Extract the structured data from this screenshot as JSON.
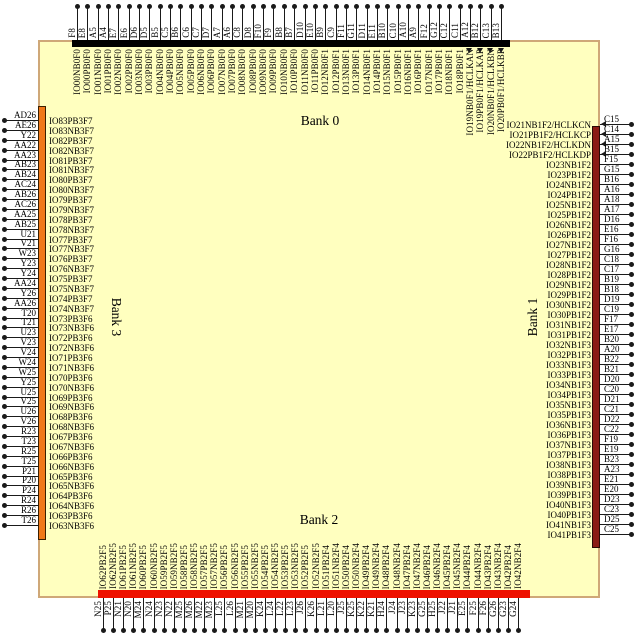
{
  "colors": {
    "die_fill": "#ffffbf",
    "die_border": "#cfa878",
    "bank0_bar": "#000000",
    "bank1_bar": "#8b1c15",
    "bank2_bar": "#ee1100",
    "bank3_bar": "#f07818",
    "wire": "#1a1a1a"
  },
  "banks": {
    "top": {
      "label": "Bank 0",
      "pins": [
        [
          "F8",
          "IO00NB0F0"
        ],
        [
          "E8",
          "IO00PB0F0"
        ],
        [
          "A5",
          "IO01NB0F0"
        ],
        [
          "A4",
          "IO01PB0F0"
        ],
        [
          "E7",
          "IO02NB0F0"
        ],
        [
          "E6",
          "IO02PB0F0"
        ],
        [
          "D6",
          "IO03NB0F0"
        ],
        [
          "D5",
          "IO03PB0F0"
        ],
        [
          "B5",
          "IO04NB0F0"
        ],
        [
          "C5",
          "IO04PB0F0"
        ],
        [
          "B6",
          "IO05NB0F0"
        ],
        [
          "C6",
          "IO05PB0F0"
        ],
        [
          "C7",
          "IO06NB0F0"
        ],
        [
          "D7",
          "IO06PB0F0"
        ],
        [
          "A7",
          "IO07NB0F0"
        ],
        [
          "A6",
          "IO07PB0F0"
        ],
        [
          "C8",
          "IO08NB0F0"
        ],
        [
          "D8",
          "IO08PB0F0"
        ],
        [
          "F10",
          "IO09NB0F0"
        ],
        [
          "F9",
          "IO09PB0F0"
        ],
        [
          "B8",
          "IO10NB0F0"
        ],
        [
          "B7",
          "IO10PB0F0"
        ],
        [
          "D10",
          "IO11NB0F0"
        ],
        [
          "E10",
          "IO11PB0F0"
        ],
        [
          "B9",
          "IO12NB0F1"
        ],
        [
          "C9",
          "IO12PB0F1"
        ],
        [
          "F11",
          "IO13NB0F1"
        ],
        [
          "G11",
          "IO13PB0F1"
        ],
        [
          "D11",
          "IO14NB0F1"
        ],
        [
          "E11",
          "IO14PB0F1"
        ],
        [
          "B10",
          "IO15NB0F1"
        ],
        [
          "C10",
          "IO15PB0F1"
        ],
        [
          "A10",
          "IO16NB0F1"
        ],
        [
          "A9",
          "IO16PB0F1"
        ],
        [
          "F12",
          "IO17NB0F1"
        ],
        [
          "G12",
          "IO17PB0F1"
        ],
        [
          "C12",
          "IO18NB0F1"
        ],
        [
          "C11",
          "IO18PB0F1"
        ],
        [
          "A12",
          "IO19NB0F1/HCLKAN"
        ],
        [
          "B12",
          "IO19PB0F1/HCLKAP"
        ],
        [
          "C13",
          "IO20NB0F1/HCLKBN"
        ],
        [
          "B13",
          "IO20PB0F1/HCLKBP"
        ]
      ]
    },
    "right": {
      "label": "Bank 1",
      "pins": [
        [
          "C15",
          "IO21NB1F2/HCLKCN"
        ],
        [
          "C14",
          "IO21PB1F2/HCLKCP"
        ],
        [
          "A15",
          "IO22NB1F2/HCLKDN"
        ],
        [
          "B15",
          "IO22PB1F2/HCLKDP"
        ],
        [
          "F15",
          "IO23NB1F2"
        ],
        [
          "G15",
          "IO23PB1F2"
        ],
        [
          "B16",
          "IO24NB1F2"
        ],
        [
          "A16",
          "IO24PB1F2"
        ],
        [
          "A18",
          "IO25NB1F2"
        ],
        [
          "A17",
          "IO25PB1F2"
        ],
        [
          "D16",
          "IO26NB1F2"
        ],
        [
          "E16",
          "IO26PB1F2"
        ],
        [
          "F16",
          "IO27NB1F2"
        ],
        [
          "G16",
          "IO27PB1F2"
        ],
        [
          "C18",
          "IO28NB1F2"
        ],
        [
          "C17",
          "IO28PB1F2"
        ],
        [
          "B19",
          "IO29NB1F2"
        ],
        [
          "B18",
          "IO29PB1F2"
        ],
        [
          "D19",
          "IO30NB1F2"
        ],
        [
          "C19",
          "IO30PB1F2"
        ],
        [
          "F17",
          "IO31NB1F2"
        ],
        [
          "E17",
          "IO31PB1F2"
        ],
        [
          "B20",
          "IO32NB1F3"
        ],
        [
          "A20",
          "IO32PB1F3"
        ],
        [
          "B22",
          "IO33NB1F3"
        ],
        [
          "B21",
          "IO33PB1F3"
        ],
        [
          "D20",
          "IO34NB1F3"
        ],
        [
          "C20",
          "IO34PB1F3"
        ],
        [
          "D21",
          "IO35NB1F3"
        ],
        [
          "C21",
          "IO35PB1F3"
        ],
        [
          "D22",
          "IO36NB1F3"
        ],
        [
          "C22",
          "IO36PB1F3"
        ],
        [
          "F19",
          "IO37NB1F3"
        ],
        [
          "E19",
          "IO37PB1F3"
        ],
        [
          "B23",
          "IO38NB1F3"
        ],
        [
          "A23",
          "IO38PB1F3"
        ],
        [
          "E21",
          "IO39NB1F3"
        ],
        [
          "E20",
          "IO39PB1F3"
        ],
        [
          "D23",
          "IO40NB1F3"
        ],
        [
          "C23",
          "IO40PB1F3"
        ],
        [
          "D25",
          "IO41NB1F3"
        ],
        [
          "C25",
          "IO41PB1F3"
        ]
      ]
    },
    "bottom": {
      "label": "Bank 2",
      "pins": [
        [
          "N25",
          "IO62PB2F5"
        ],
        [
          "P25",
          "IO62NB2F5"
        ],
        [
          "N21",
          "IO61PB2F5"
        ],
        [
          "N20",
          "IO61NB2F5"
        ],
        [
          "M24",
          "IO60PB2F5"
        ],
        [
          "N24",
          "IO60NB2F5"
        ],
        [
          "N23",
          "IO59PB2F5"
        ],
        [
          "N22",
          "IO59NB2F5"
        ],
        [
          "M25",
          "IO58PB2F5"
        ],
        [
          "M26",
          "IO58NB2F5"
        ],
        [
          "M22",
          "IO57PB2F5"
        ],
        [
          "M23",
          "IO57NB2F5"
        ],
        [
          "L25",
          "IO56PB2F5"
        ],
        [
          "L26",
          "IO56NB2F5"
        ],
        [
          "M21",
          "IO55PB2F5"
        ],
        [
          "M20",
          "IO55NB2F5"
        ],
        [
          "K24",
          "IO54PB2F5"
        ],
        [
          "L24",
          "IO54NB2F5"
        ],
        [
          "L22",
          "IO53PB2F5"
        ],
        [
          "L23",
          "IO53NB2F5"
        ],
        [
          "J26",
          "IO52PB2F5"
        ],
        [
          "K26",
          "IO52NB2F5"
        ],
        [
          "L21",
          "IO51PB2F4"
        ],
        [
          "L20",
          "IO51NB2F4"
        ],
        [
          "J25",
          "IO50PB2F4"
        ],
        [
          "K25",
          "IO50NB2F4"
        ],
        [
          "K22",
          "IO49PB2F4"
        ],
        [
          "K21",
          "IO49NB2F4"
        ],
        [
          "H24",
          "IO48PB2F4"
        ],
        [
          "J24",
          "IO48NB2F4"
        ],
        [
          "J23",
          "IO47PB2F4"
        ],
        [
          "K23",
          "IO47NB2F4"
        ],
        [
          "G25",
          "IO46PB2F4"
        ],
        [
          "H25",
          "IO46NB2F4"
        ],
        [
          "J22",
          "IO45PB2F4"
        ],
        [
          "J21",
          "IO45NB2F4"
        ],
        [
          "E25",
          "IO44PB2F4"
        ],
        [
          "F25",
          "IO44NB2F4"
        ],
        [
          "F26",
          "IO43PB2F4"
        ],
        [
          "G26",
          "IO43NB2F4"
        ],
        [
          "G23",
          "IO42PB2F4"
        ],
        [
          "G24",
          "IO42NB2F4"
        ]
      ]
    },
    "left": {
      "label": "Bank 3",
      "pins": [
        [
          "AD26",
          "IO83PB3F7"
        ],
        [
          "AE26",
          "IO83NB3F7"
        ],
        [
          "Y22",
          "IO82PB3F7"
        ],
        [
          "AA22",
          "IO82NB3F7"
        ],
        [
          "AA23",
          "IO81PB3F7"
        ],
        [
          "AB23",
          "IO81NB3F7"
        ],
        [
          "AB24",
          "IO80PB3F7"
        ],
        [
          "AC24",
          "IO80NB3F7"
        ],
        [
          "AB26",
          "IO79PB3F7"
        ],
        [
          "AC26",
          "IO79NB3F7"
        ],
        [
          "AA25",
          "IO78PB3F7"
        ],
        [
          "AB25",
          "IO78NB3F7"
        ],
        [
          "U21",
          "IO77PB3F7"
        ],
        [
          "V21",
          "IO77NB3F7"
        ],
        [
          "W23",
          "IO76PB3F7"
        ],
        [
          "Y23",
          "IO76NB3F7"
        ],
        [
          "Y24",
          "IO75PB3F7"
        ],
        [
          "AA24",
          "IO75NB3F7"
        ],
        [
          "Y26",
          "IO74PB3F7"
        ],
        [
          "AA26",
          "IO74NB3F7"
        ],
        [
          "T20",
          "IO73PB3F6"
        ],
        [
          "T21",
          "IO73NB3F6"
        ],
        [
          "U23",
          "IO72PB3F6"
        ],
        [
          "V23",
          "IO72NB3F6"
        ],
        [
          "V24",
          "IO71PB3F6"
        ],
        [
          "W24",
          "IO71NB3F6"
        ],
        [
          "W25",
          "IO70PB3F6"
        ],
        [
          "Y25",
          "IO70NB3F6"
        ],
        [
          "U25",
          "IO69PB3F6"
        ],
        [
          "V25",
          "IO69NB3F6"
        ],
        [
          "U26",
          "IO68PB3F6"
        ],
        [
          "V26",
          "IO68NB3F6"
        ],
        [
          "R23",
          "IO67PB3F6"
        ],
        [
          "T23",
          "IO67NB3F6"
        ],
        [
          "R25",
          "IO66PB3F6"
        ],
        [
          "T25",
          "IO66NB3F6"
        ],
        [
          "P21",
          "IO65PB3F6"
        ],
        [
          "P20",
          "IO65NB3F6"
        ],
        [
          "P24",
          "IO64PB3F6"
        ],
        [
          "R24",
          "IO64NB3F6"
        ],
        [
          "R26",
          "IO63PB3F6"
        ],
        [
          "T26",
          "IO63NB3F6"
        ]
      ]
    }
  }
}
